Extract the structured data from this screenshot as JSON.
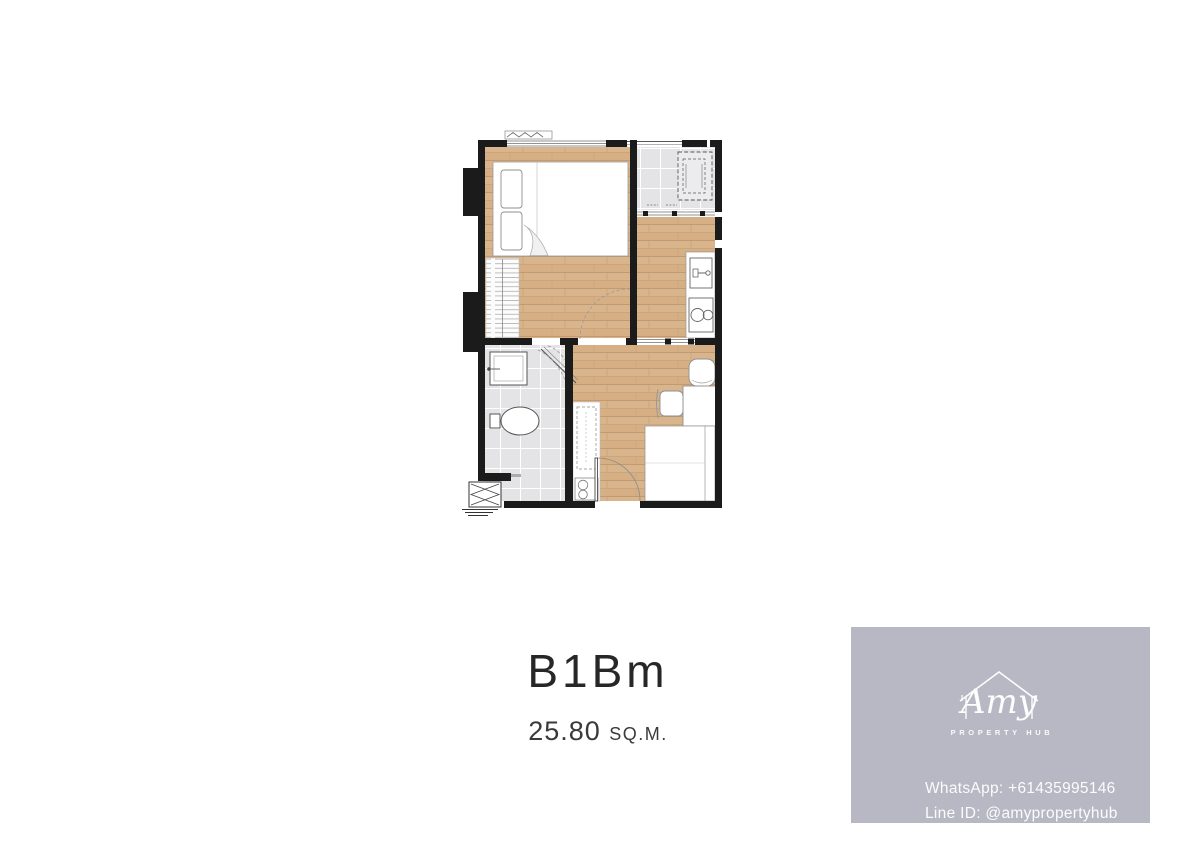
{
  "colors": {
    "wall": "#1b1b1b",
    "wood": "#d9b58e",
    "tile": "#e4e4e6",
    "card-bg": "#b7b8c4",
    "ink": "#2f2f31",
    "card-ink": "#ffffff"
  },
  "unit": {
    "name": "B1Bm",
    "area": "25.80",
    "area_unit": "SQ.M."
  },
  "contact_card": {
    "brand": {
      "icon": "house-outline-icon",
      "script_name": "Amy",
      "tagline": "PROPERTY HUB"
    },
    "whatsapp": "WhatsApp: +61435995146",
    "line_id": "Line ID: @amypropertyhub"
  }
}
